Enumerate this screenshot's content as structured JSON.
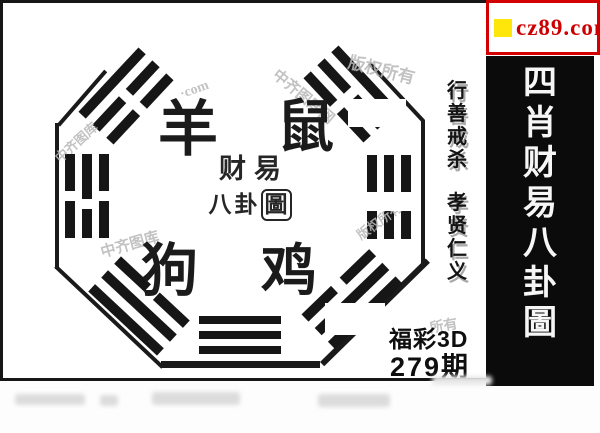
{
  "badge": {
    "site": "cz89.com",
    "icon": "yellow-square-icon"
  },
  "banner": {
    "title": "四肖财易八卦圖"
  },
  "motto": {
    "group1": "行善戒杀",
    "group2": "孝贤仁义"
  },
  "zodiac": {
    "top_left": "羊",
    "top_right": "鼠",
    "bottom_left": "狗",
    "bottom_right": "鸡"
  },
  "seal": {
    "line1": "财易",
    "line2_chars": [
      "八",
      "卦",
      "圖"
    ]
  },
  "issue": {
    "game": "福彩3D",
    "period": "279期"
  },
  "trigrams": {
    "top_left": [
      "solid",
      "broken",
      "broken"
    ],
    "top_right": [
      "solid",
      "broken",
      "broken"
    ],
    "left": [
      "broken",
      "broken",
      "broken"
    ],
    "right": [
      "broken",
      "broken",
      "broken"
    ],
    "bottom_left": [
      "broken",
      "solid",
      "solid"
    ],
    "bottom_right": [
      "broken",
      "solid",
      "solid"
    ],
    "bottom": [
      "solid",
      "solid",
      "solid"
    ]
  },
  "watermarks": [
    {
      "text": "版权所有"
    },
    {
      "text": "中齐图库网"
    },
    {
      "text": "中齐图库"
    },
    {
      "text": "版权所有"
    },
    {
      "text": "·com"
    },
    {
      "text": "中齐图库"
    },
    {
      "text": "所有"
    }
  ],
  "colors": {
    "badge_red": "#cc0000",
    "badge_yellow": "#ffe60a",
    "banner_bg": "#0b0b0b",
    "ink": "#1a1a1a",
    "watermark_gray": "#b8b8b8"
  }
}
